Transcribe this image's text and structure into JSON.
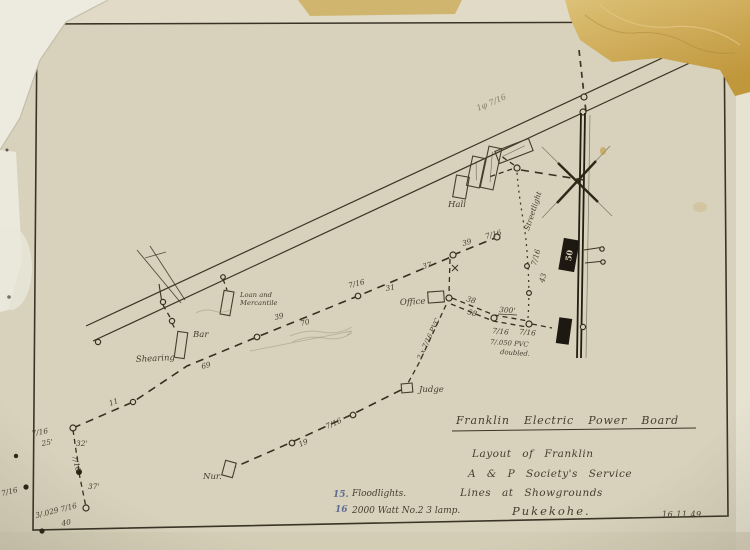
{
  "document": {
    "date": "16.11.49"
  },
  "title_block": {
    "line1": "Franklin Electric Power Board",
    "line2": "Layout of Franklin",
    "line3": "A & P Society's Service",
    "line4": "Lines at Showgrounds",
    "line5": "Pukekohe."
  },
  "notes": {
    "item1_number": "15.",
    "item1_text": "Floodlights.",
    "item2_number": "16",
    "item2_text": "2000 Watt No.2 3 lamp."
  },
  "map_labels": {
    "shearing": "Shearing",
    "bar": "Bar",
    "loan_line1": "Loan and",
    "loan_line2": "Mercantile",
    "hall": "Hall",
    "office": "Office",
    "judge": "Judge",
    "nursery": "Nur.",
    "streetlight": "Streetlight",
    "phase_line": "1φ 7/16",
    "pvc_doubled_line1": "7/.050 PVC",
    "pvc_doubled_line2": "doubled.",
    "pvc_2x": "2 x 7/16 PVC",
    "transformer_rating": "50"
  },
  "measurements": [
    "11",
    "69",
    "39",
    "70",
    "7/16",
    "31",
    "37",
    "39",
    "7/16",
    "38",
    "58",
    "300'",
    "7/16",
    "7/16",
    "7/16",
    "43",
    "19",
    "7/16",
    "7/16",
    "25'",
    "32'",
    "7/16",
    "37'",
    "3/.029 7/16",
    "40",
    "7/16"
  ],
  "colors": {
    "ink": "#453e2f",
    "paper": "#d8d2bc",
    "blue_note": "#5f6c96",
    "stain_patch": "#c9a24b"
  }
}
